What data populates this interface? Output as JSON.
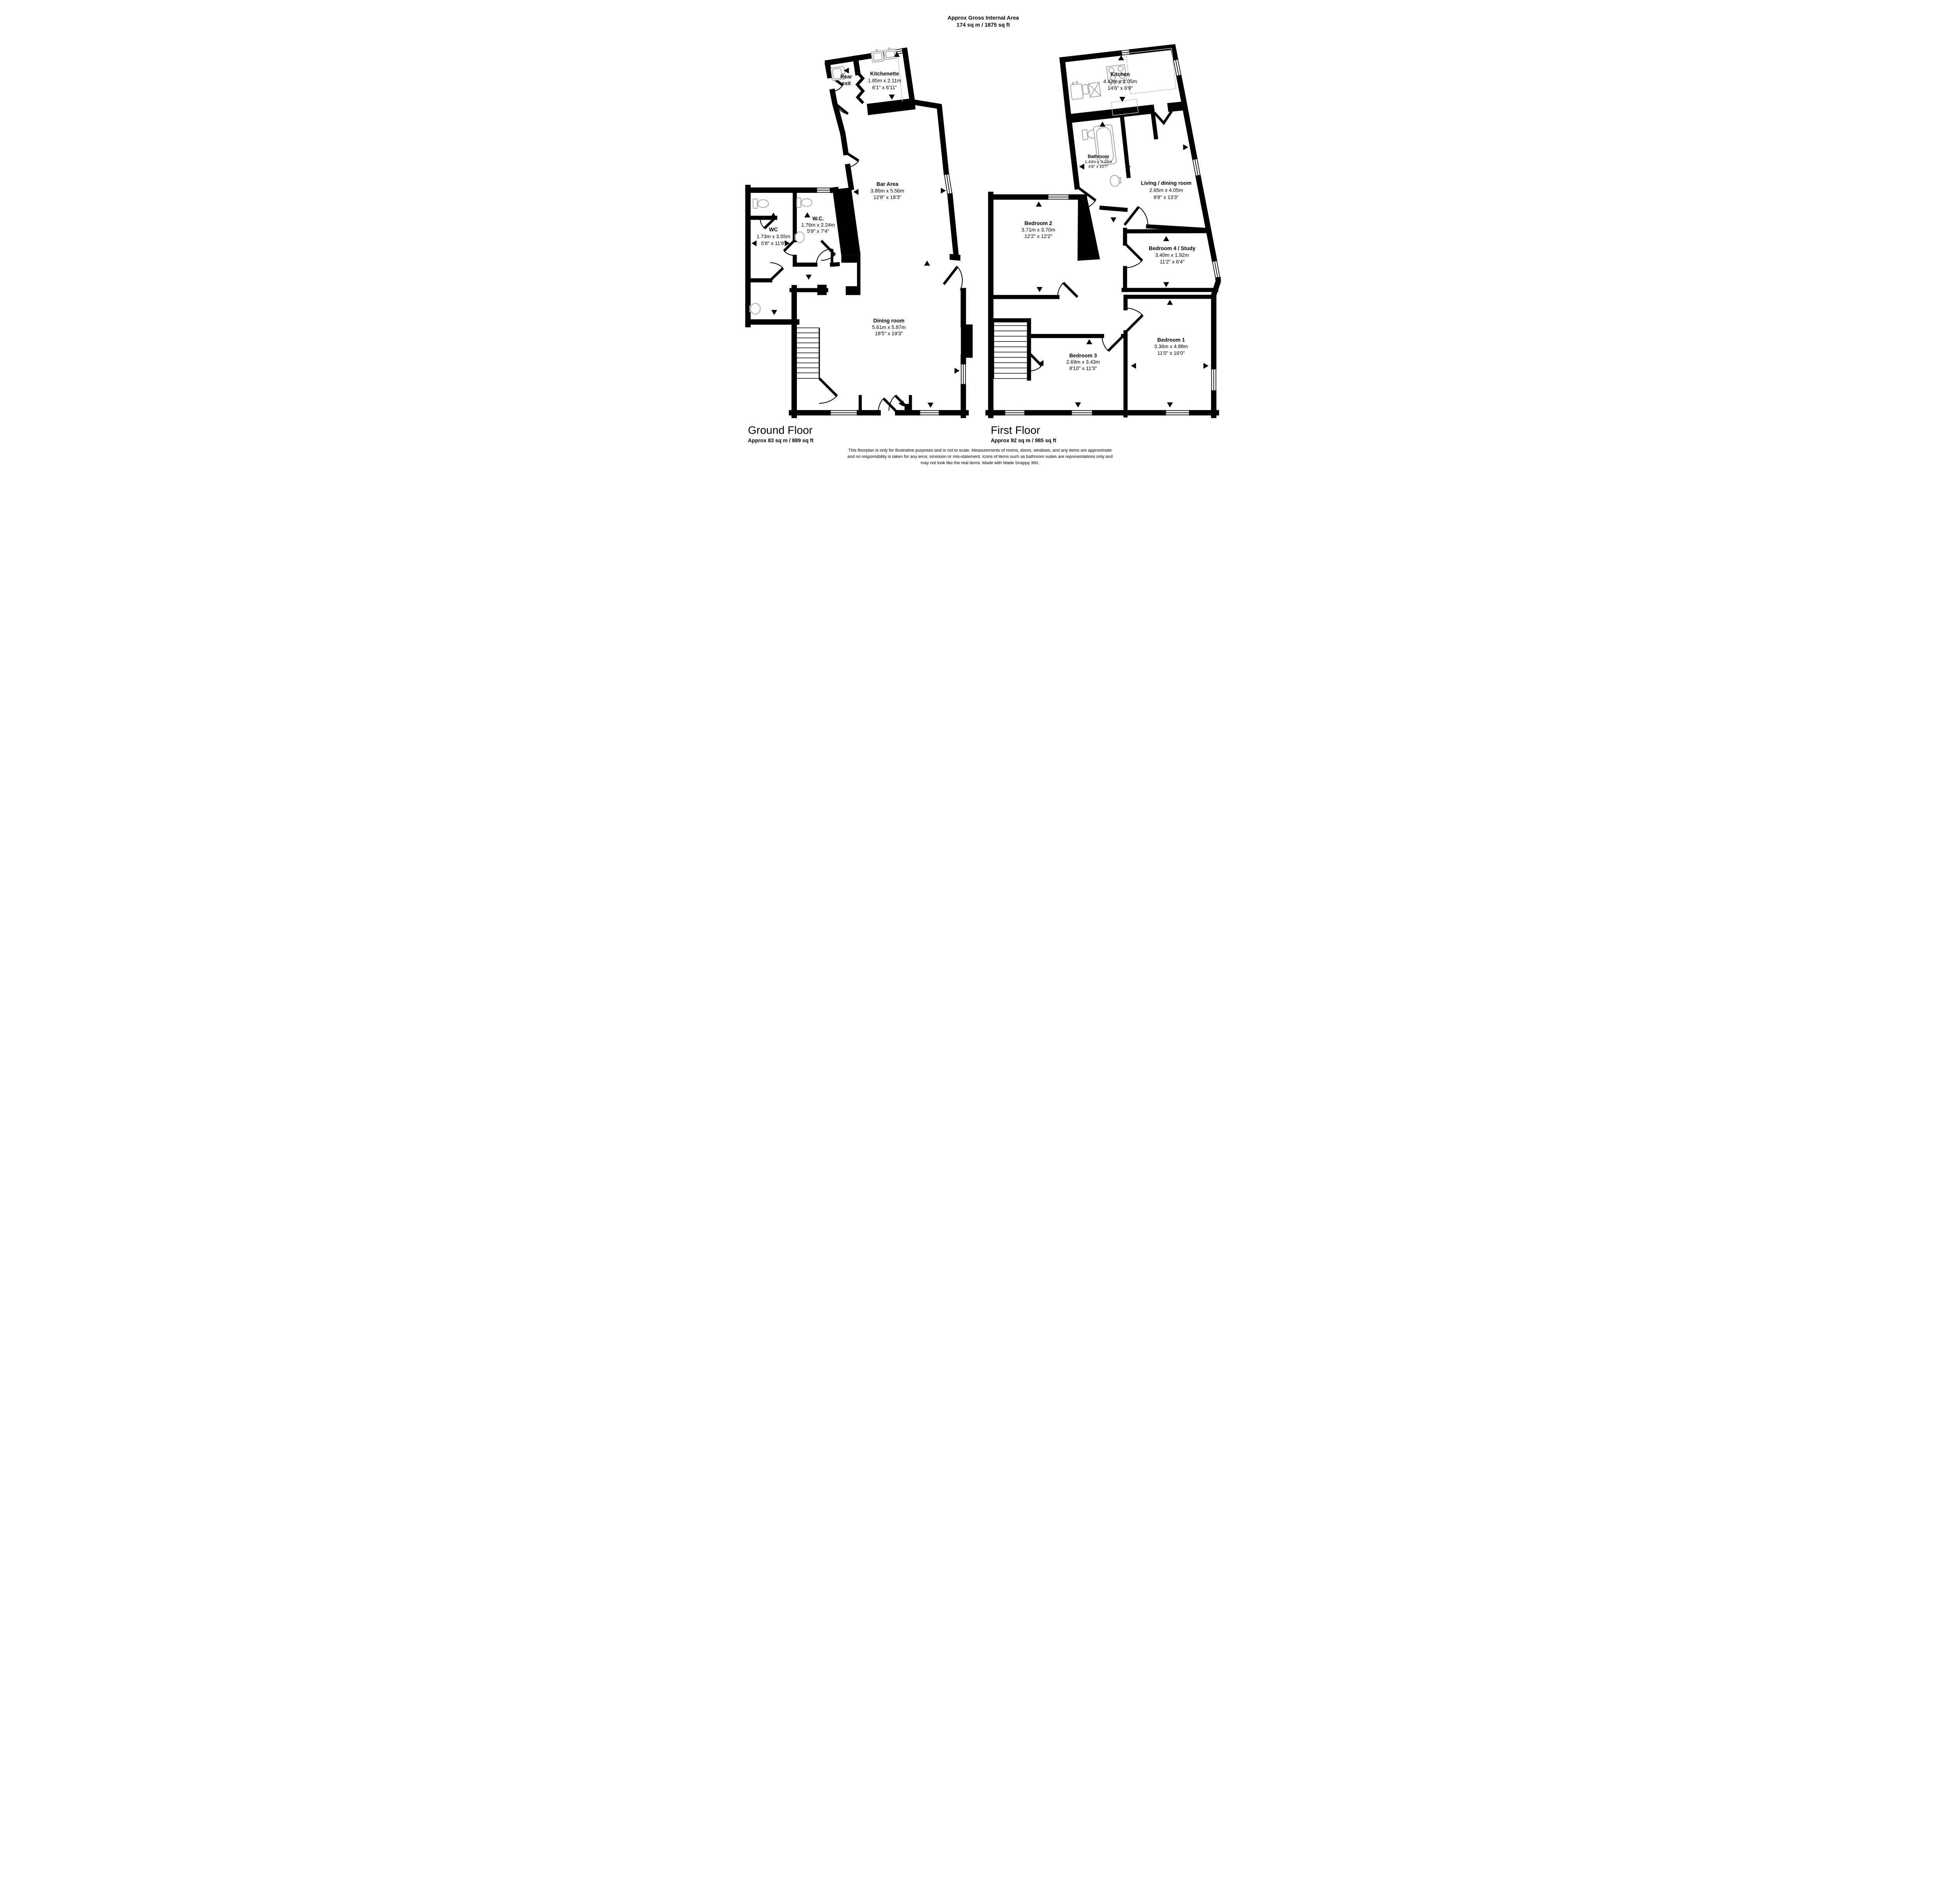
{
  "header": {
    "title": "Approx Gross Internal Area",
    "area": "174 sq m / 1875 sq ft"
  },
  "ground_floor": {
    "label": "Ground Floor",
    "area": "Approx 83 sq m / 889 sq ft",
    "rooms": {
      "rear_exit": {
        "line1": "Rear",
        "line2": "exit"
      },
      "kitchenette": {
        "name": "Kitchenette",
        "metric": "1.85m x 2.11m",
        "imperial": "6'1\" x 6'11\""
      },
      "bar": {
        "name": "Bar Area",
        "metric": "3.86m x 5.56m",
        "imperial": "12'8\" x 18'3\""
      },
      "wc": {
        "name": "WC",
        "metric": "1.73m x 3.55m",
        "imperial": "5'8\" x 11'8\""
      },
      "wc2": {
        "name": "W.C.",
        "metric": "1.76m x 2.24m",
        "imperial": "5'9\" x 7'4\""
      },
      "dining": {
        "name": "Dining room",
        "metric": "5.61m x 5.87m",
        "imperial": "18'5\" x 19'3\""
      }
    }
  },
  "first_floor": {
    "label": "First Floor",
    "area": "Approx 92 sq m / 985 sq ft",
    "rooms": {
      "kitchen": {
        "name": "Kitchen",
        "metric": "4.42m x 2.05m",
        "imperial": "14'6\" x 6'9\""
      },
      "bathroom": {
        "name": "Bathroom",
        "metric": "1.43m x 3.22m",
        "imperial": "4'8\" x 10'7\""
      },
      "living": {
        "name": "Living / dining room",
        "metric": "2.65m x 4.05m",
        "imperial": "8'8\" x 13'3\""
      },
      "bedroom2": {
        "name": "Bedroom 2",
        "metric": "3.71m x 3.70m",
        "imperial": "12'2\" x 12'2\""
      },
      "bedroom4": {
        "name": "Bedroom 4 / Study",
        "metric": "3.40m x 1.92m",
        "imperial": "11'2\" x 6'4\""
      },
      "bedroom3": {
        "name": "Bedroom 3",
        "metric": "2.69m x 3.43m",
        "imperial": "8'10\" x 11'3\""
      },
      "bedroom1": {
        "name": "Bedroom 1",
        "metric": "3.36m x 4.88m",
        "imperial": "11'0\" x 16'0\""
      }
    }
  },
  "disclaimer": {
    "line1": "This floorplan is only for illustrative purposes and is not to scale. Measurements of rooms, doors, windows, and any items are approximate",
    "line2": "and no responsibility is taken for any error, omission or mis-statement. Icons of items such as bathroom suites are representations only and",
    "line3": "may not look like the real items. Made with Made Snappy 360."
  },
  "colors": {
    "wall": "#000000",
    "fixture": "#a6a6a6"
  }
}
